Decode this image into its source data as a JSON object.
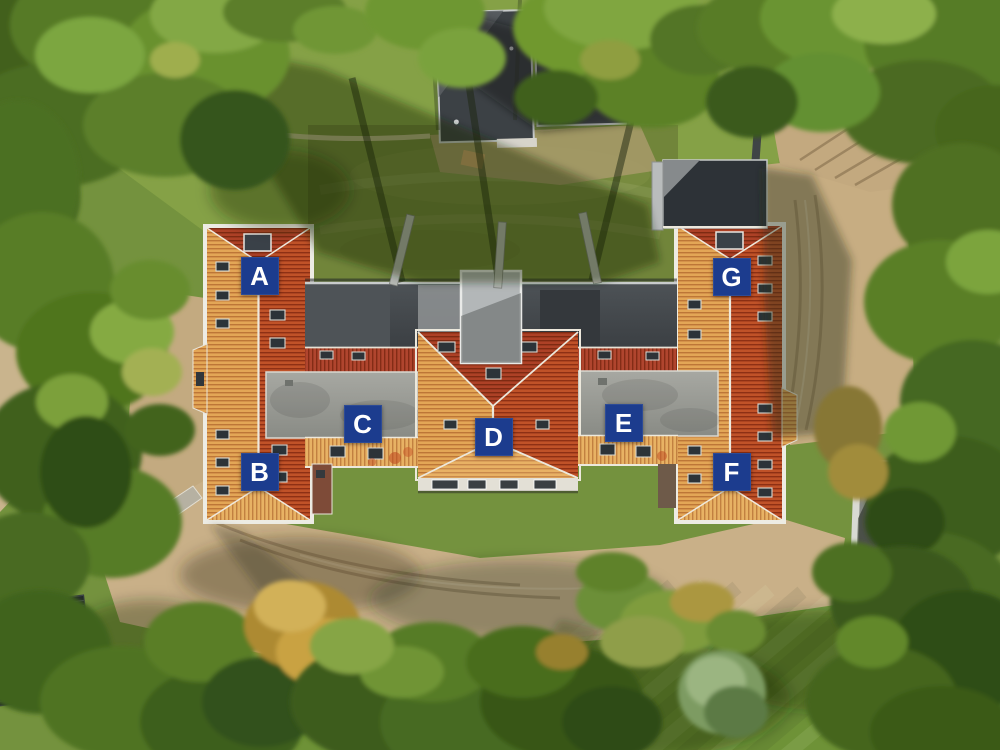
{
  "image": {
    "type": "aerial-drone-photo",
    "caption": "Top-down aerial view of a residential building complex with orange tiled roofs and grey flat roofs, surrounded by trees, lawns and sandy ground; seven apartment unit markers",
    "colors": {
      "label_background": "#1c3c8e",
      "label_text": "#ffffff",
      "roof_tile_sunlit": "#e3a656",
      "roof_tile_shaded": "#c05228",
      "flat_roof_grey": "#9b9c96",
      "dark_flat_roof": "#42474b",
      "grass": "#74923e",
      "dirt": "#c7ad82"
    }
  },
  "labels": [
    {
      "letter": "A",
      "x_pct": 25.95,
      "y_pct": 36.8
    },
    {
      "letter": "B",
      "x_pct": 25.95,
      "y_pct": 62.9
    },
    {
      "letter": "C",
      "x_pct": 36.25,
      "y_pct": 56.5
    },
    {
      "letter": "D",
      "x_pct": 49.35,
      "y_pct": 58.3
    },
    {
      "letter": "E",
      "x_pct": 62.35,
      "y_pct": 56.4
    },
    {
      "letter": "F",
      "x_pct": 73.15,
      "y_pct": 62.9
    },
    {
      "letter": "G",
      "x_pct": 73.15,
      "y_pct": 36.9
    }
  ]
}
